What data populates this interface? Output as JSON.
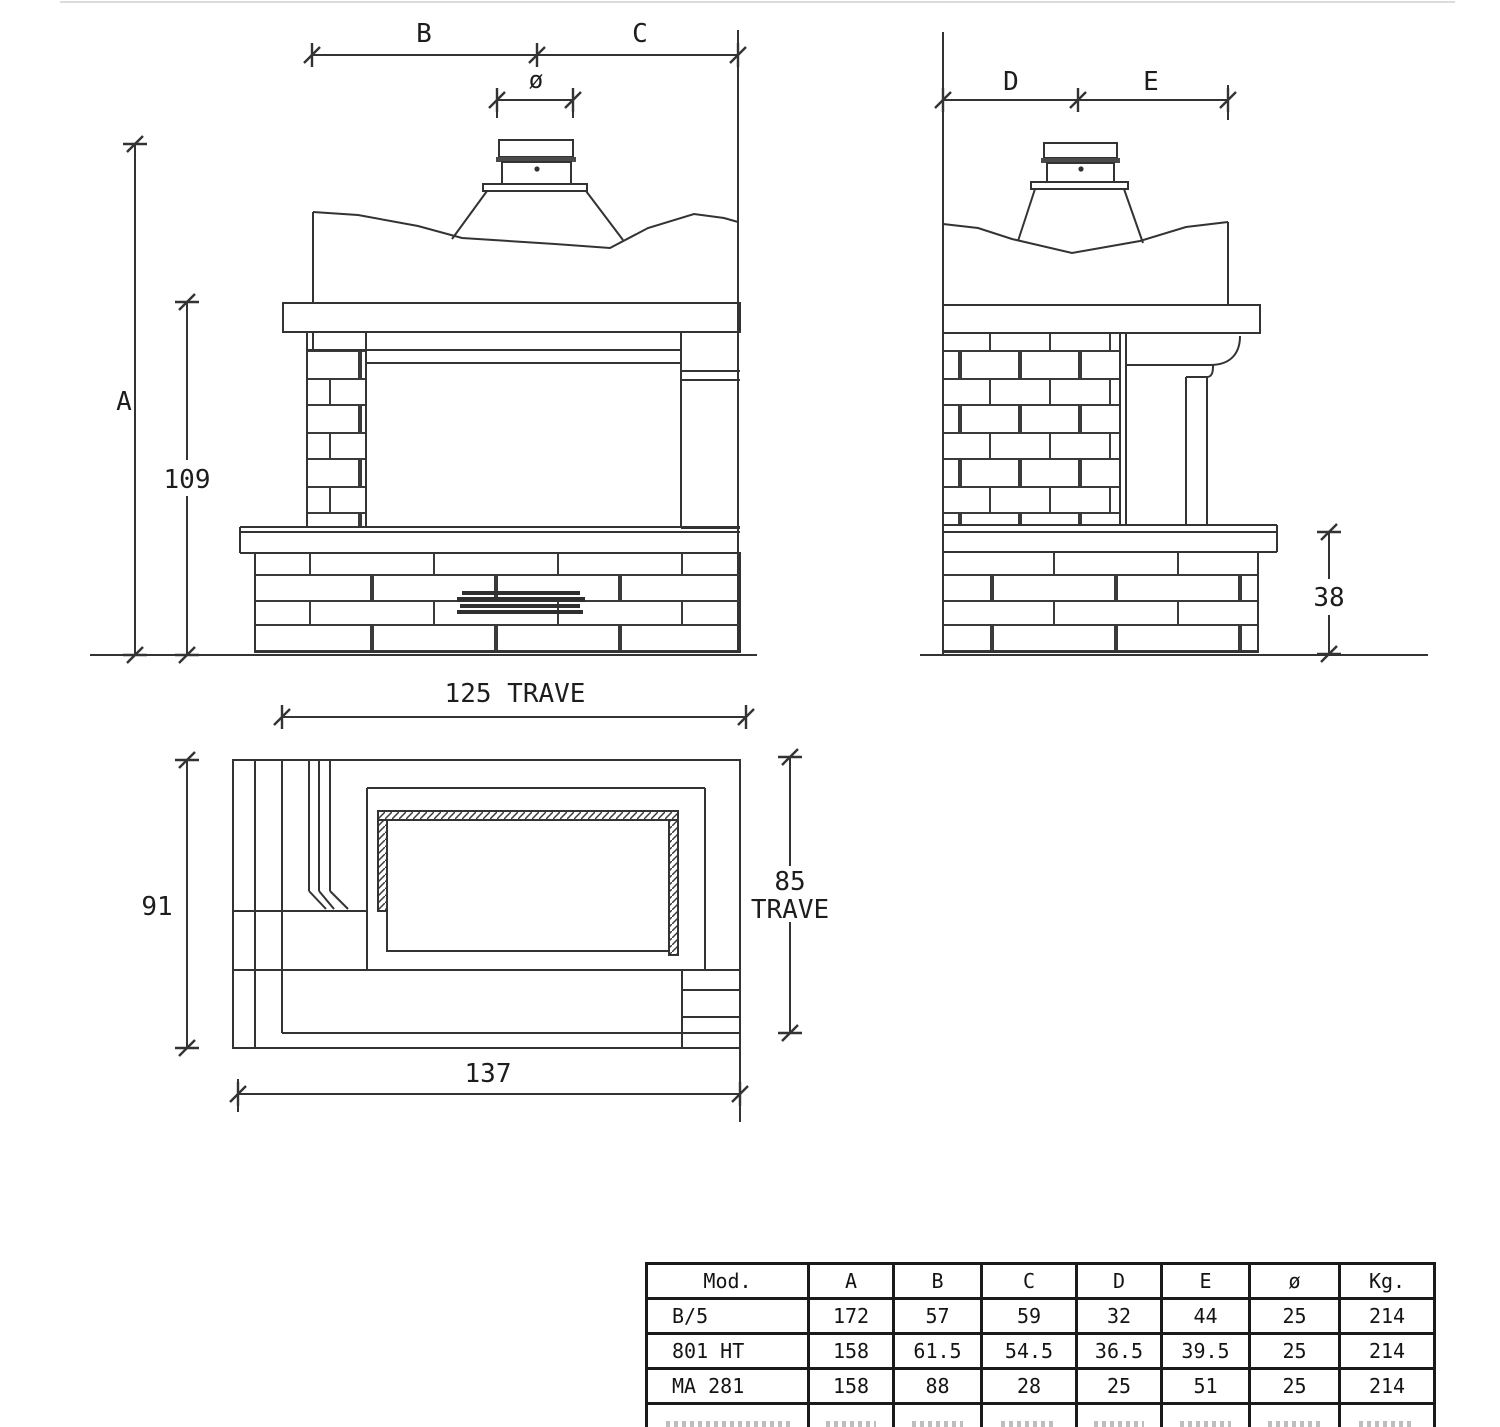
{
  "accent_colors": {
    "line": "#333333",
    "text": "#1d1d1d",
    "grille": "#2f2f2f",
    "collar_band": "#4a4a4a"
  },
  "labels": {
    "front": {
      "b": "B",
      "c": "C",
      "phi": "ø",
      "a": "A",
      "h109": "109"
    },
    "side": {
      "d": "D",
      "e": "E",
      "h38": "38"
    },
    "plan": {
      "trave125": "125  TRAVE",
      "w91": "91",
      "t85a": "85",
      "t85b": "TRAVE",
      "d137": "137"
    }
  },
  "table": {
    "headers": [
      "Mod.",
      "A",
      "B",
      "C",
      "D",
      "E",
      "ø",
      "Kg."
    ],
    "rows": [
      [
        "B/5",
        "172",
        "57",
        "59",
        "32",
        "44",
        "25",
        "214"
      ],
      [
        "801 HT",
        "158",
        "61.5",
        "54.5",
        "36.5",
        "39.5",
        "25",
        "214"
      ],
      [
        "MA 281",
        "158",
        "88",
        "28",
        "25",
        "51",
        "25",
        "214"
      ]
    ]
  }
}
